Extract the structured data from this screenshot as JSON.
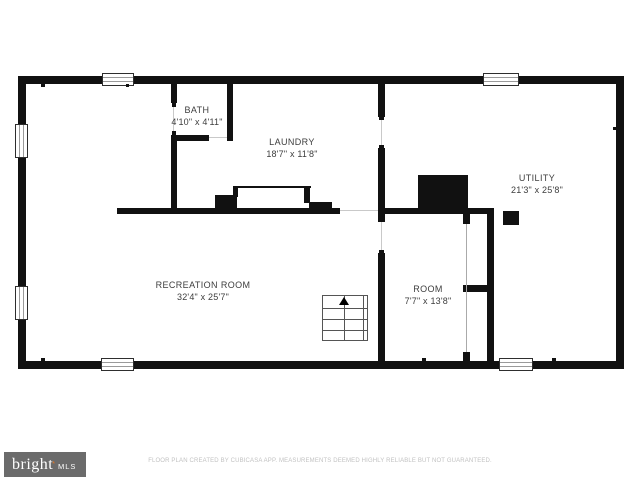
{
  "plan": {
    "rooms": [
      {
        "id": "bath",
        "name": "BATH",
        "dims": "4'10\" x 4'11\""
      },
      {
        "id": "laundry",
        "name": "LAUNDRY",
        "dims": "18'7\" x 11'8\""
      },
      {
        "id": "utility",
        "name": "UTILITY",
        "dims": "21'3\" x 25'8\""
      },
      {
        "id": "recreation",
        "name": "RECREATION ROOM",
        "dims": "32'4\" x 25'7\""
      },
      {
        "id": "room",
        "name": "ROOM",
        "dims": "7'7\" x 13'8\""
      }
    ],
    "features": [
      "stairs-up",
      "furnace-block",
      "support-post",
      "laundry-counter",
      "windows",
      "door-openings"
    ],
    "colors": {
      "wall": "#111111",
      "label": "#3d3d3d",
      "window_line": "#9a9a9a"
    }
  },
  "footer": {
    "logo": {
      "brand": "bright",
      "star": "*",
      "suffix": "MLS",
      "bg": "#6b6b6b",
      "text_color": "#ffffff",
      "accent": "#e87722"
    },
    "disclaimer": "FLOOR PLAN CREATED BY CUBICASA APP. MEASUREMENTS DEEMED HIGHLY RELIABLE BUT NOT GUARANTEED."
  }
}
